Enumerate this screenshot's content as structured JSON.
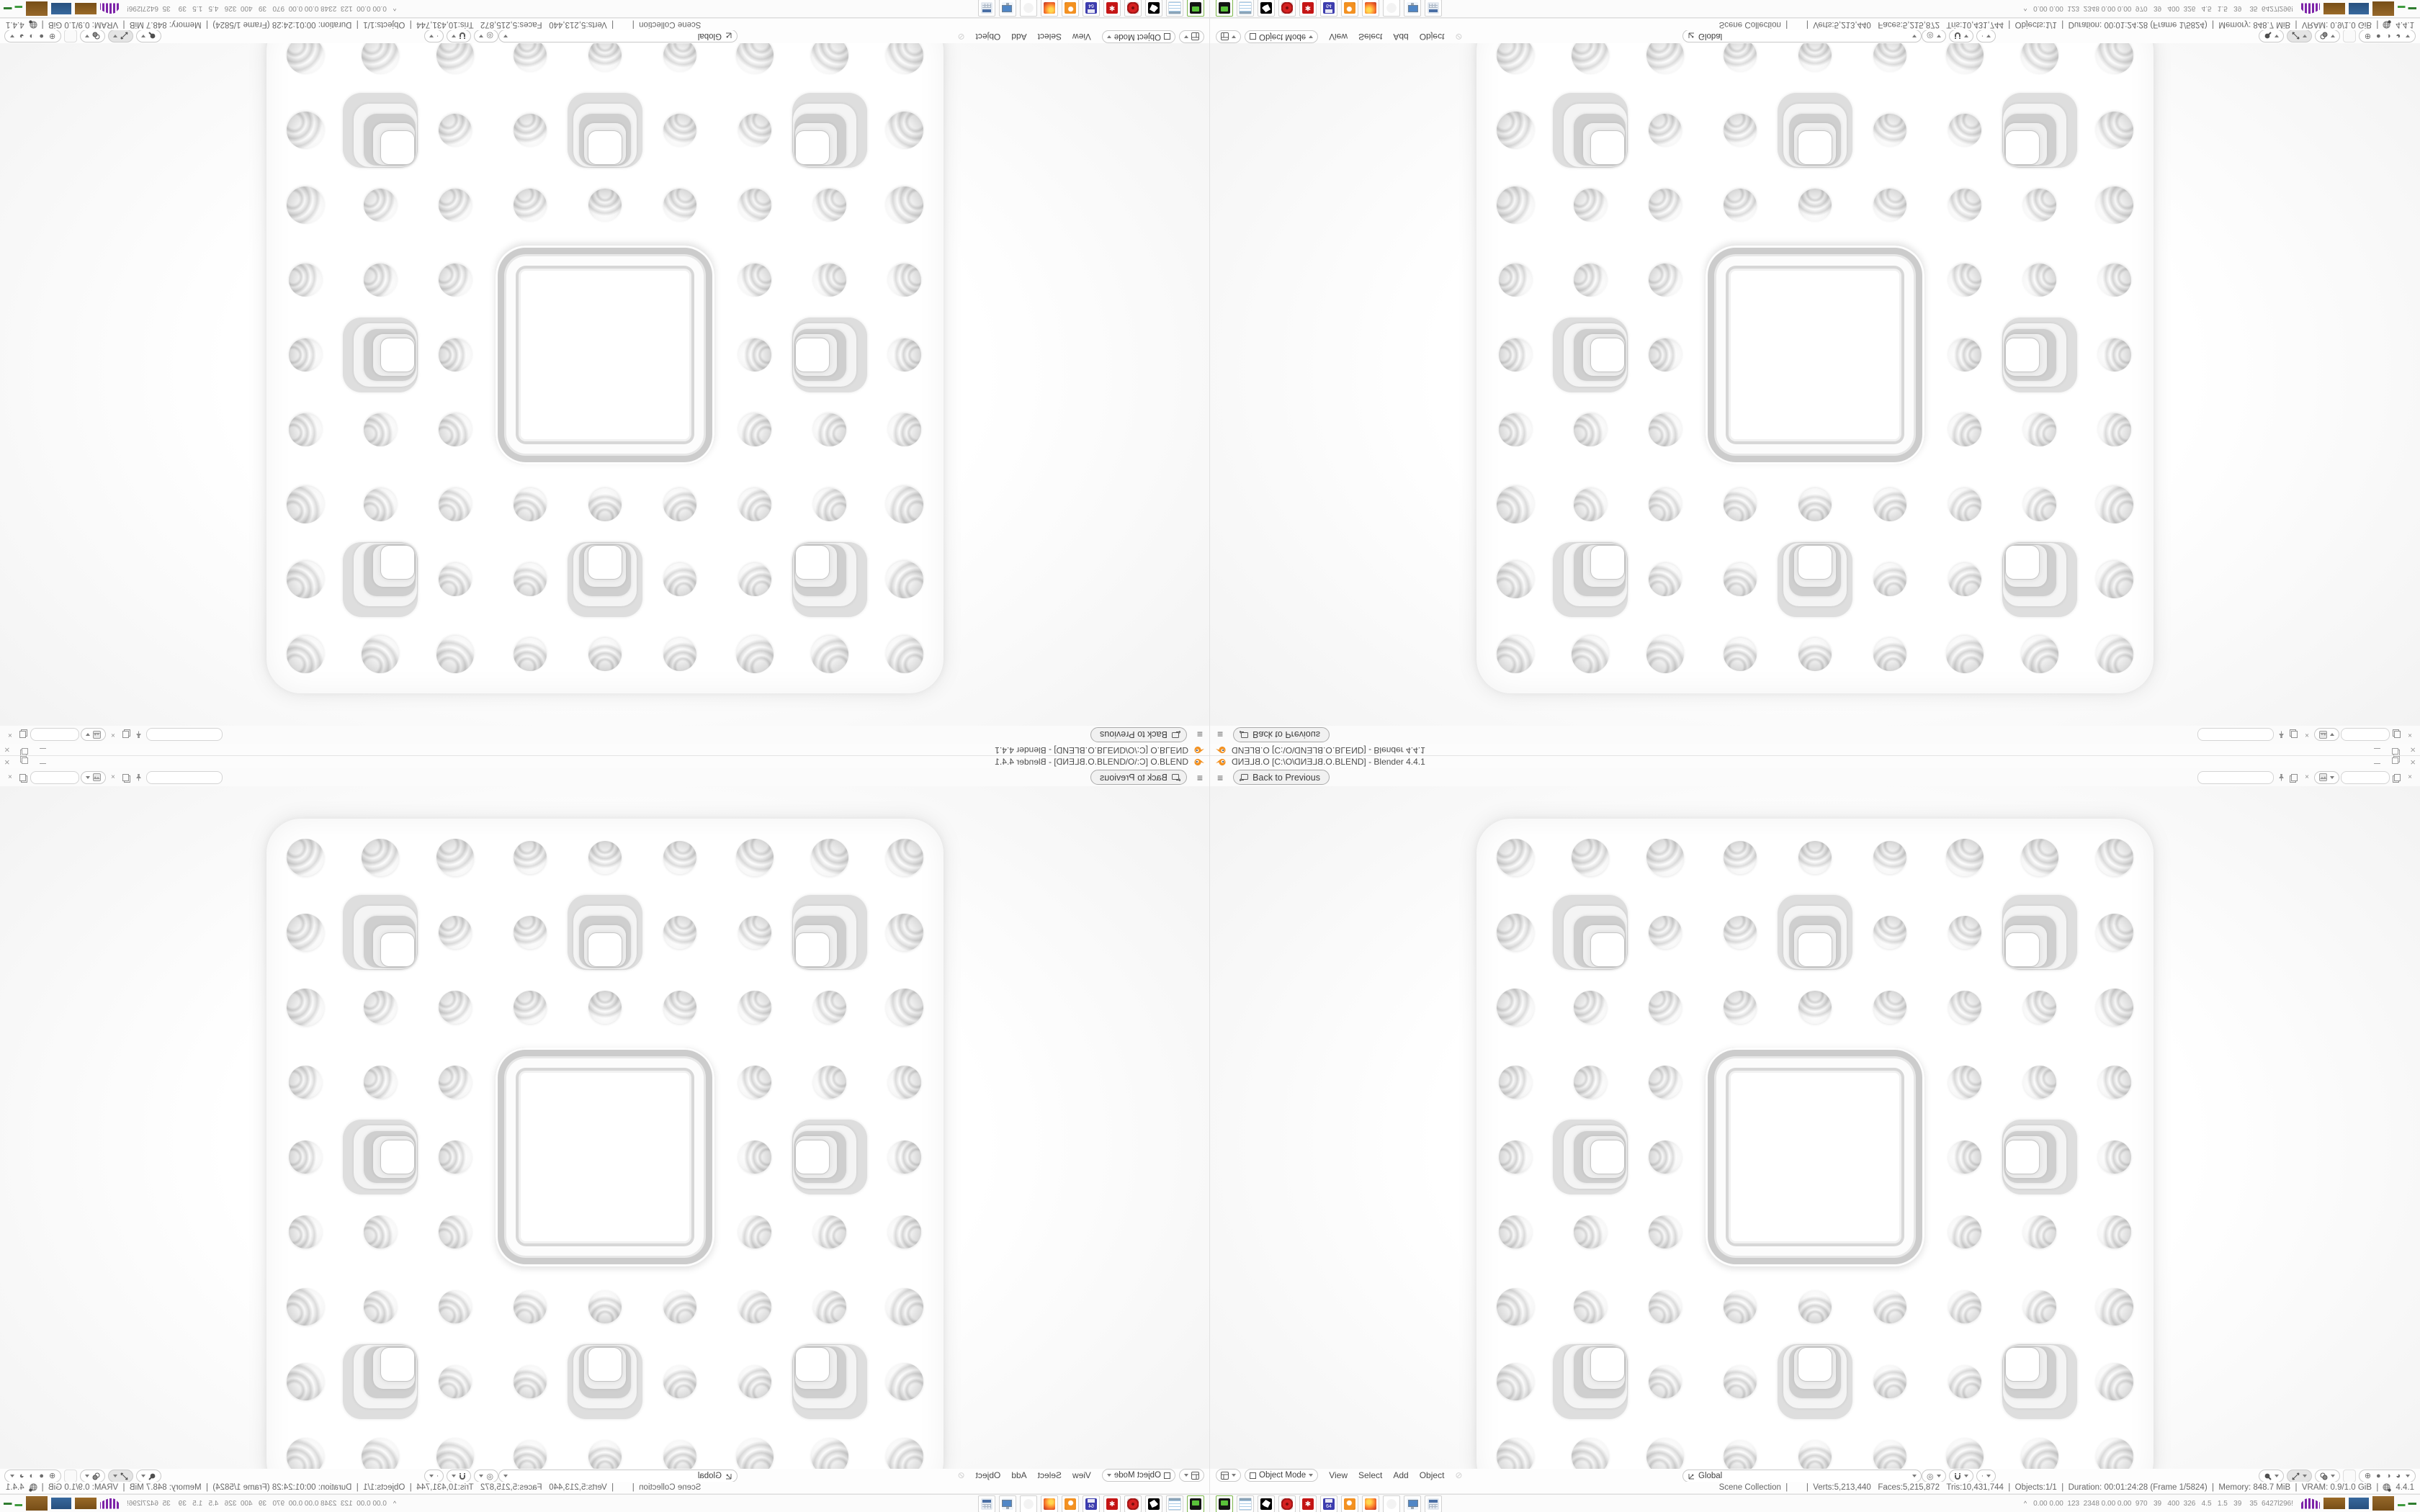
{
  "app": {
    "title_file_mirrored": "O.BLEND",
    "title_path_open": " [C:\\O\\",
    "title_path_close": ".BLEND] - Blender 4.4.1",
    "accent_color": "#f39121"
  },
  "topbar": {
    "menu_icon": "≡",
    "back_label": "Back to Previous"
  },
  "viewport_header": {
    "mode_label": "Object Mode",
    "menus": [
      "View",
      "Select",
      "Add",
      "Object"
    ],
    "orientation_label": "Global",
    "shading_icons": [
      "wireframe",
      "solid",
      "material-preview",
      "rendered"
    ]
  },
  "statusbar": {
    "stats": "Scene Collection  |        |  Verts:5,213,440   Faces:5,215,872   Tris:10,431,744  |  Objects:1/1  |  Duration: 00:01:24:28 (Frame 1/5824)  |  Memory: 848.7 MiB  |  VRAM: 0.9/1.0 GiB  |",
    "version": "4.4.1"
  },
  "taskbar": {
    "overflow_chevron": "^",
    "tray_text": "0.00 0.00  123  2348 0.00 0.00  970   39   400  326   4.5   1.5   39    35  6427l296!",
    "apps": [
      "capture-device",
      "notepad",
      "gimp",
      "red-badge",
      "red-gear",
      "installer-64",
      "blender",
      "firefox",
      "ghost",
      "display-settings",
      "calculator"
    ]
  },
  "fractal": {
    "grid": 9,
    "pitch": 104,
    "plate_size": 940,
    "circle_diameter": 46,
    "square_size": 104,
    "big_square_size": 304,
    "square_cells": [
      [
        1,
        1
      ],
      [
        1,
        4
      ],
      [
        1,
        7
      ],
      [
        4,
        1
      ],
      [
        4,
        7
      ],
      [
        7,
        1
      ],
      [
        7,
        4
      ],
      [
        7,
        7
      ]
    ]
  },
  "quadrants": [
    {
      "id": "top-left",
      "transform": "rotate-180"
    },
    {
      "id": "top-right",
      "transform": "flip-v"
    },
    {
      "id": "bottom-left",
      "transform": "flip-h"
    },
    {
      "id": "bottom-right",
      "transform": "none"
    }
  ],
  "misc": {
    "gear_glyph": "✱",
    "floppy_label": "64",
    "disabled_circle": "⊘",
    "shade_wire": "⊕",
    "shade_solid": "●",
    "shade_material": "◑",
    "shade_rendered": "◕",
    "prop_edit": "◎"
  }
}
